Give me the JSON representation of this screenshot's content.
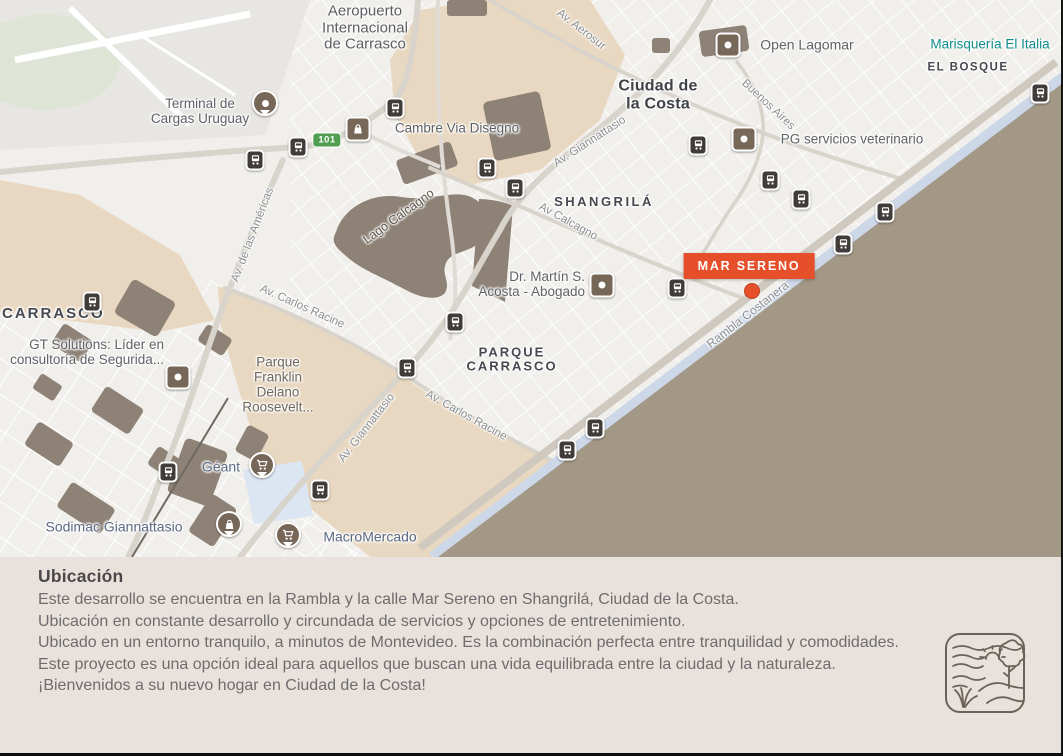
{
  "map": {
    "marker": {
      "label": "MAR SERENO"
    },
    "route_badge": "101",
    "localities": {
      "ciudad_de_la_costa": "Ciudad de\nla Costa",
      "shangrila": "SHANGRILÁ",
      "el_bosque": "EL BOSQUE",
      "parque_carrasco": "PARQUE\nCARRASCO",
      "carrasco": "CARRASCO"
    },
    "streets": {
      "av_aerosur": "Av. Aerosur",
      "av_giannattasio_1": "Av. Giannattasio",
      "av_giannattasio_2": "Av. Giannattasio",
      "buenos_aires": "Buenos Aires",
      "av_calcagno": "Av Calcagno",
      "av_de_las_americas": "Av. de las Américas",
      "av_carlos_racine_1": "Av. Carlos Racine",
      "av_carlos_racine_2": "Av. Carlos Racine",
      "rambla_costanera": "Rambla Costanera"
    },
    "water": {
      "lago_calcagno": "Lago Calcagno"
    },
    "pois": {
      "aeropuerto": "Aeropuerto\nInternacional\nde Carrasco",
      "terminal_cargas": "Terminal de\nCargas Uruguay",
      "cambre": "Cambre Via Disegno",
      "open_lagomar": "Open Lagomar",
      "marisqueria": "Marisquería El Italia",
      "pg_veterinario": "PG servicios veterinario",
      "dr_martin": "Dr. Martín S.\nAcosta - Abogado",
      "gt_solutions": "GT Solutions: Líder en\nconsultoría de Segurida...",
      "parque_franklin": "Parque\nFranklin\nDelano\nRoosevelt...",
      "geant": "Géant",
      "sodimac": "Sodimac Giannattasio",
      "macromercado": "MacroMercado"
    }
  },
  "info": {
    "title": "Ubicación",
    "paragraphs": [
      "Este desarrollo se encuentra en la Rambla y la calle Mar Sereno en Shangrilá, Ciudad de la Costa.",
      "Ubicación en constante desarrollo y circundada de servicios y opciones de entretenimiento.",
      "Ubicado en un entorno tranquilo, a minutos de Montevideo. Es la combinación perfecta entre tranquilidad y comodidades.",
      "Este proyecto es una opción ideal para aquellos que buscan una vida equilibrada entre la ciudad y la naturaleza.",
      "¡Bienvenidos a su nuevo hogar en Ciudad de la Costa!"
    ]
  },
  "colors": {
    "accent": "#e5502b",
    "sea": "#a39786",
    "park_tan": "#e9d8c1",
    "info_bg": "#e9e2dc"
  }
}
